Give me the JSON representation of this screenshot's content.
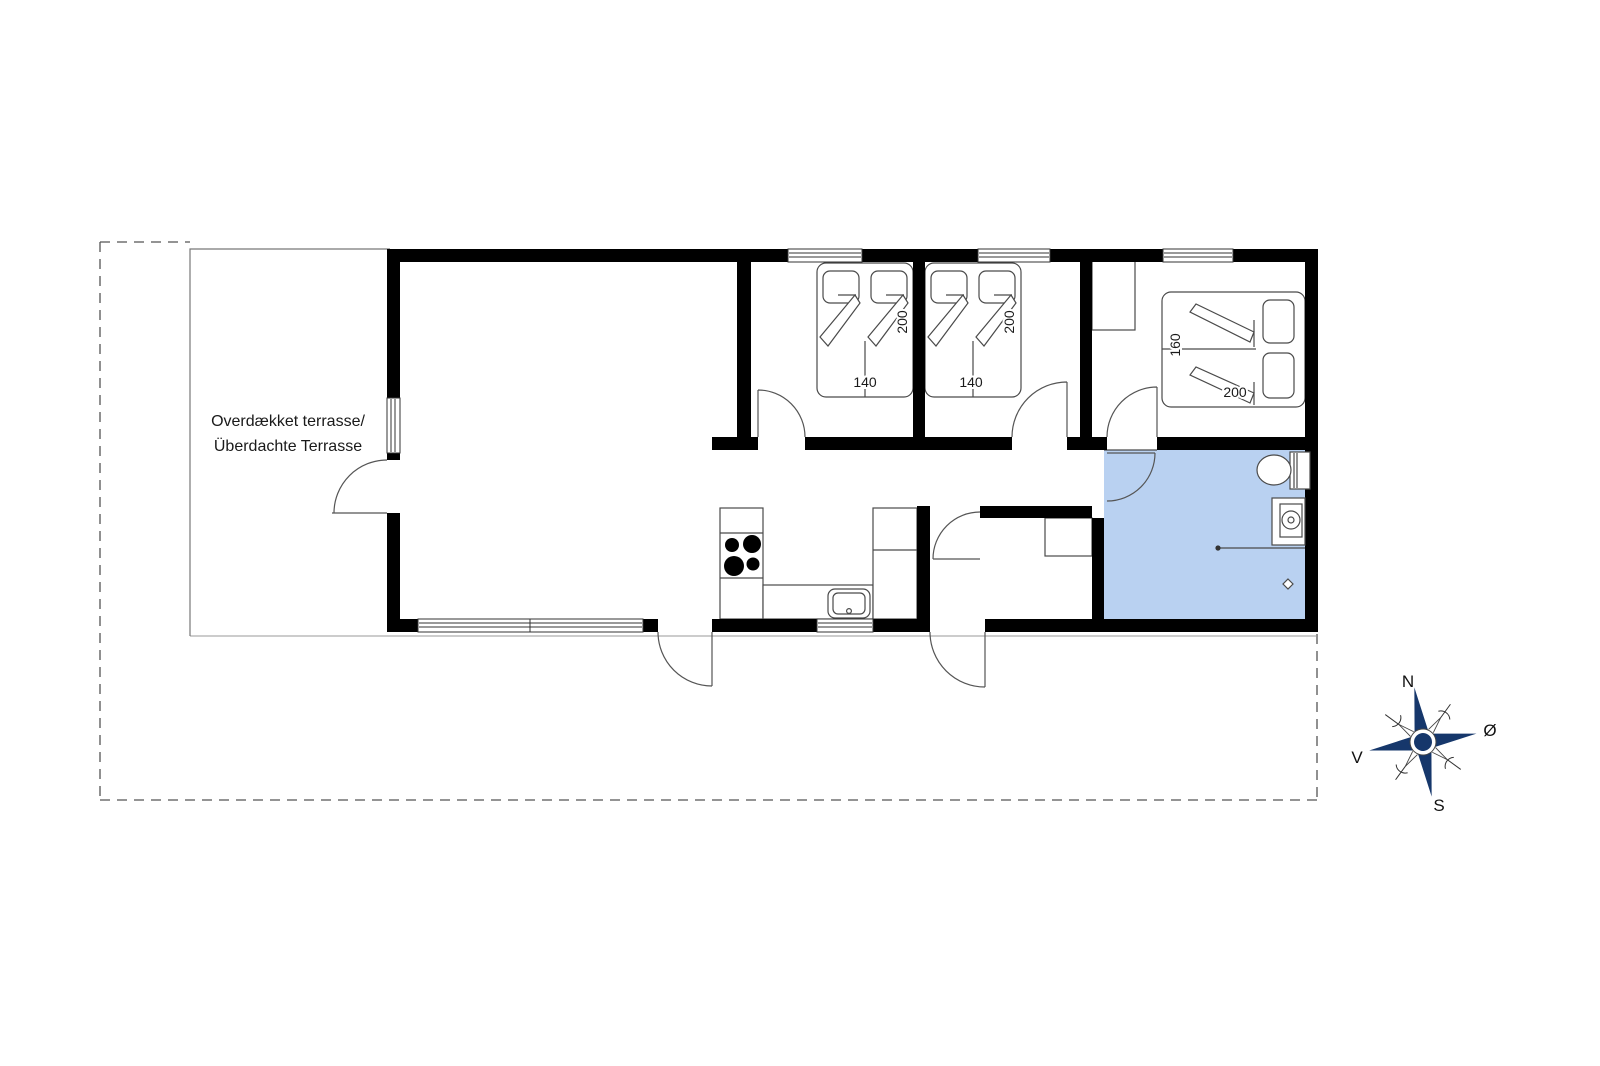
{
  "colors": {
    "bathroom_fill": "#b9d1f1",
    "compass_navy": "#16376b",
    "wall": "#000000"
  },
  "terrace": {
    "label_line1": "Overdækket terrasse/",
    "label_line2": "Überdachte Terrasse"
  },
  "bedroom1": {
    "bed_width": "140",
    "bed_length": "200"
  },
  "bedroom2": {
    "bed_width": "140",
    "bed_length": "200"
  },
  "bedroom3": {
    "bed_width": "160",
    "bed_length": "200"
  },
  "compass": {
    "north": "N",
    "east": "Ø",
    "south": "S",
    "west": "V"
  }
}
